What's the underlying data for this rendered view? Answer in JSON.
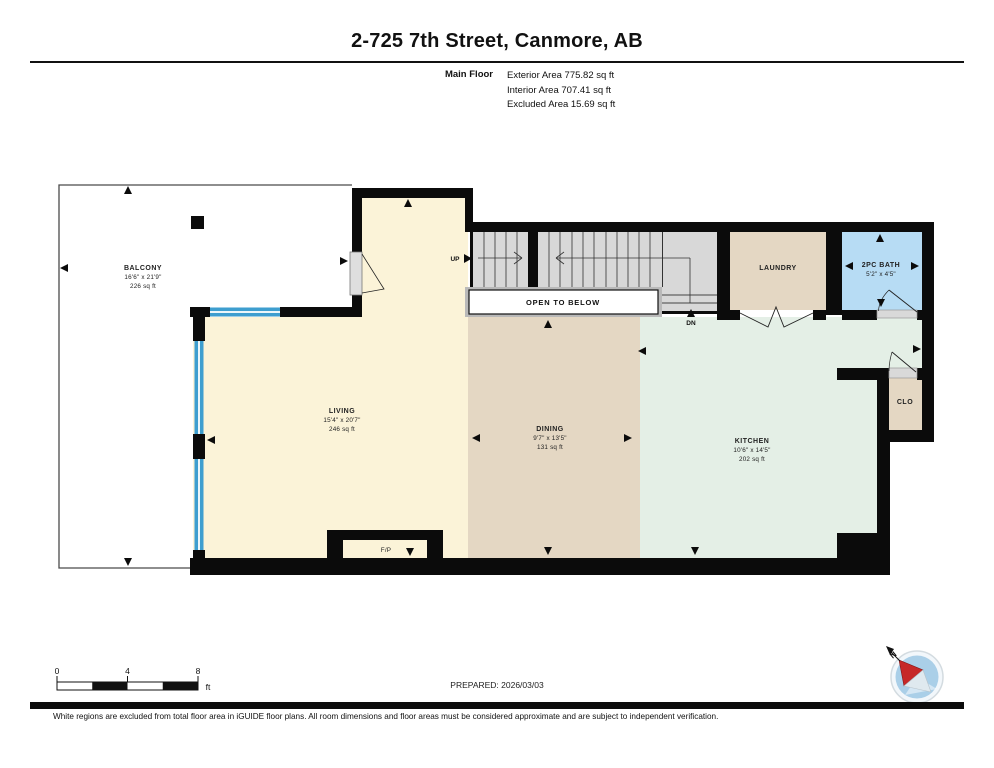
{
  "header": {
    "title": "2-725 7th Street, Canmore, AB",
    "floor_label": "Main Floor",
    "areas": {
      "exterior": "Exterior Area 775.82 sq ft",
      "interior": "Interior Area 707.41 sq ft",
      "excluded": "Excluded Area 15.69 sq ft"
    }
  },
  "rooms": {
    "balcony": {
      "name": "BALCONY",
      "dims": "16'6\" x 21'9\"",
      "area": "226 sq ft"
    },
    "living": {
      "name": "LIVING",
      "dims": "15'4\" x 20'7\"",
      "area": "246 sq ft"
    },
    "dining": {
      "name": "DINING",
      "dims": "9'7\" x 13'5\"",
      "area": "131 sq ft"
    },
    "kitchen": {
      "name": "KITCHEN",
      "dims": "10'6\" x 14'5\"",
      "area": "202 sq ft"
    },
    "laundry": {
      "name": "LAUNDRY"
    },
    "bath": {
      "name": "2PC BATH",
      "dims": "5'2\" x 4'5\""
    },
    "closet": {
      "name": "CLO"
    }
  },
  "annotations": {
    "up": "UP",
    "down": "DN",
    "open_to_below": "OPEN TO BELOW",
    "fireplace": "F/P",
    "north": "N"
  },
  "scale_bar": {
    "labels": [
      "0",
      "4",
      "8"
    ],
    "unit": "ft"
  },
  "footer": {
    "prepared": "PREPARED: 2026/03/03",
    "disclaimer": "White regions are excluded from total floor area in iGUIDE floor plans. All room dimensions and floor areas must be considered approximate and are subject to independent verification."
  },
  "colors": {
    "living_cream": "#fbf3d8",
    "dining_tan": "#e4d7c3",
    "kitchen_green": "#e4efe6",
    "bath_blue": "#b7dcf4",
    "window_blue": "#3e9ecf",
    "stairs_gray": "#d8d8d8",
    "wall_black": "#0b0b0b"
  }
}
